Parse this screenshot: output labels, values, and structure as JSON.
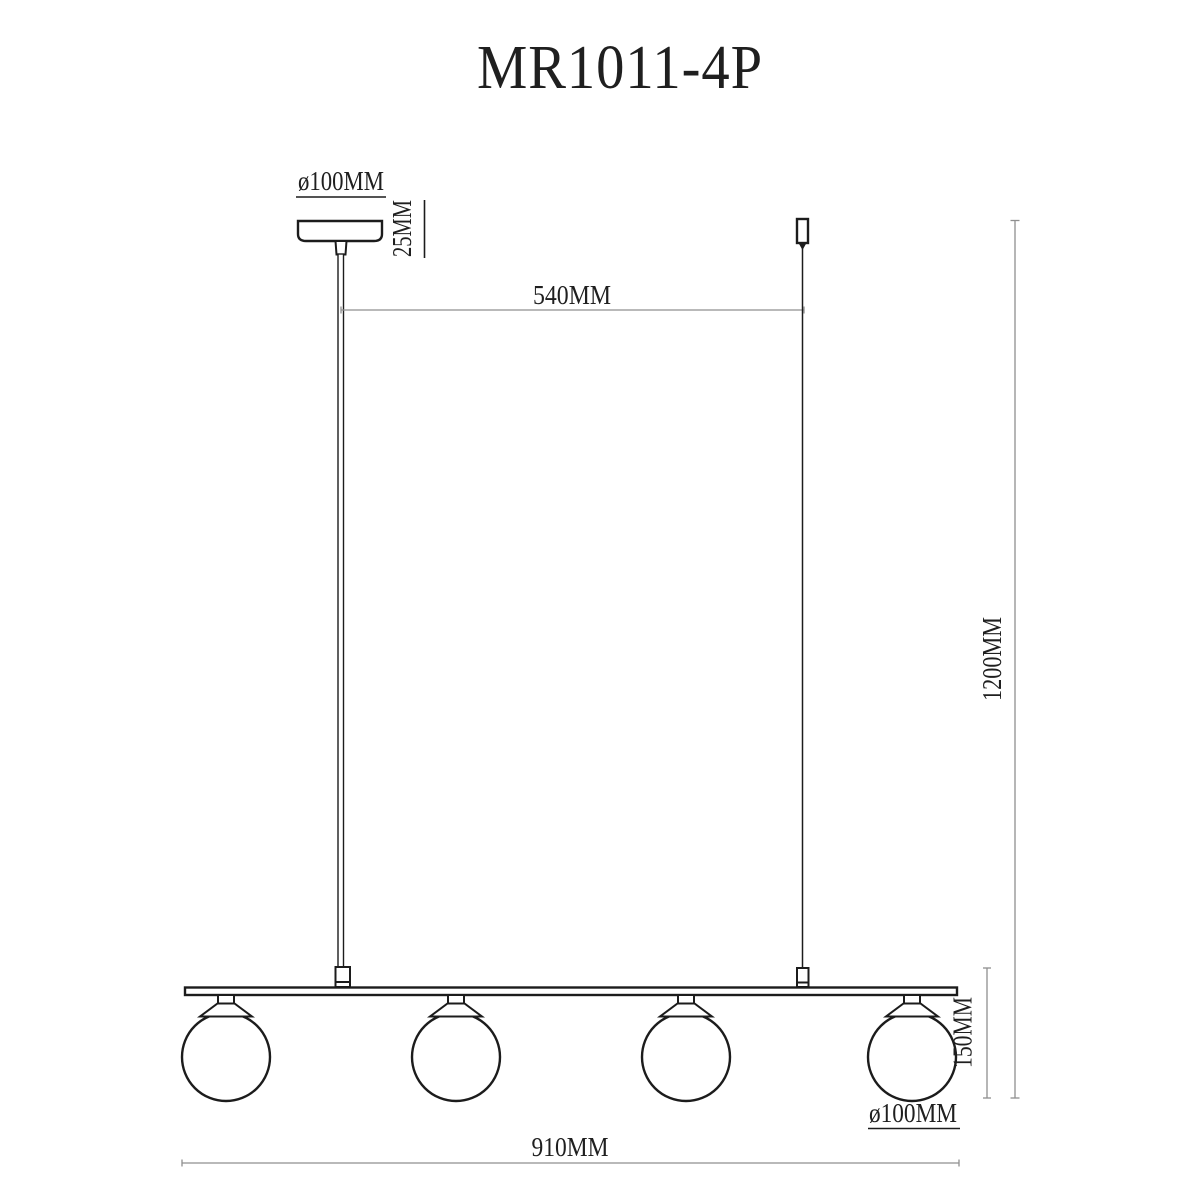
{
  "title": "MR1011-4P",
  "labels": {
    "canopy_diameter": "ø100MM",
    "canopy_height": "25MM",
    "suspension_span": "540MM",
    "overall_height": "1200MM",
    "shade_height": "150MM",
    "shade_diameter": "ø100MM",
    "bar_length": "910MM"
  },
  "drawing": {
    "globe_count": 4
  },
  "colors": {
    "outline": "#1c1c1c",
    "dimension_line": "#8f8f8f",
    "background": "#ffffff"
  }
}
